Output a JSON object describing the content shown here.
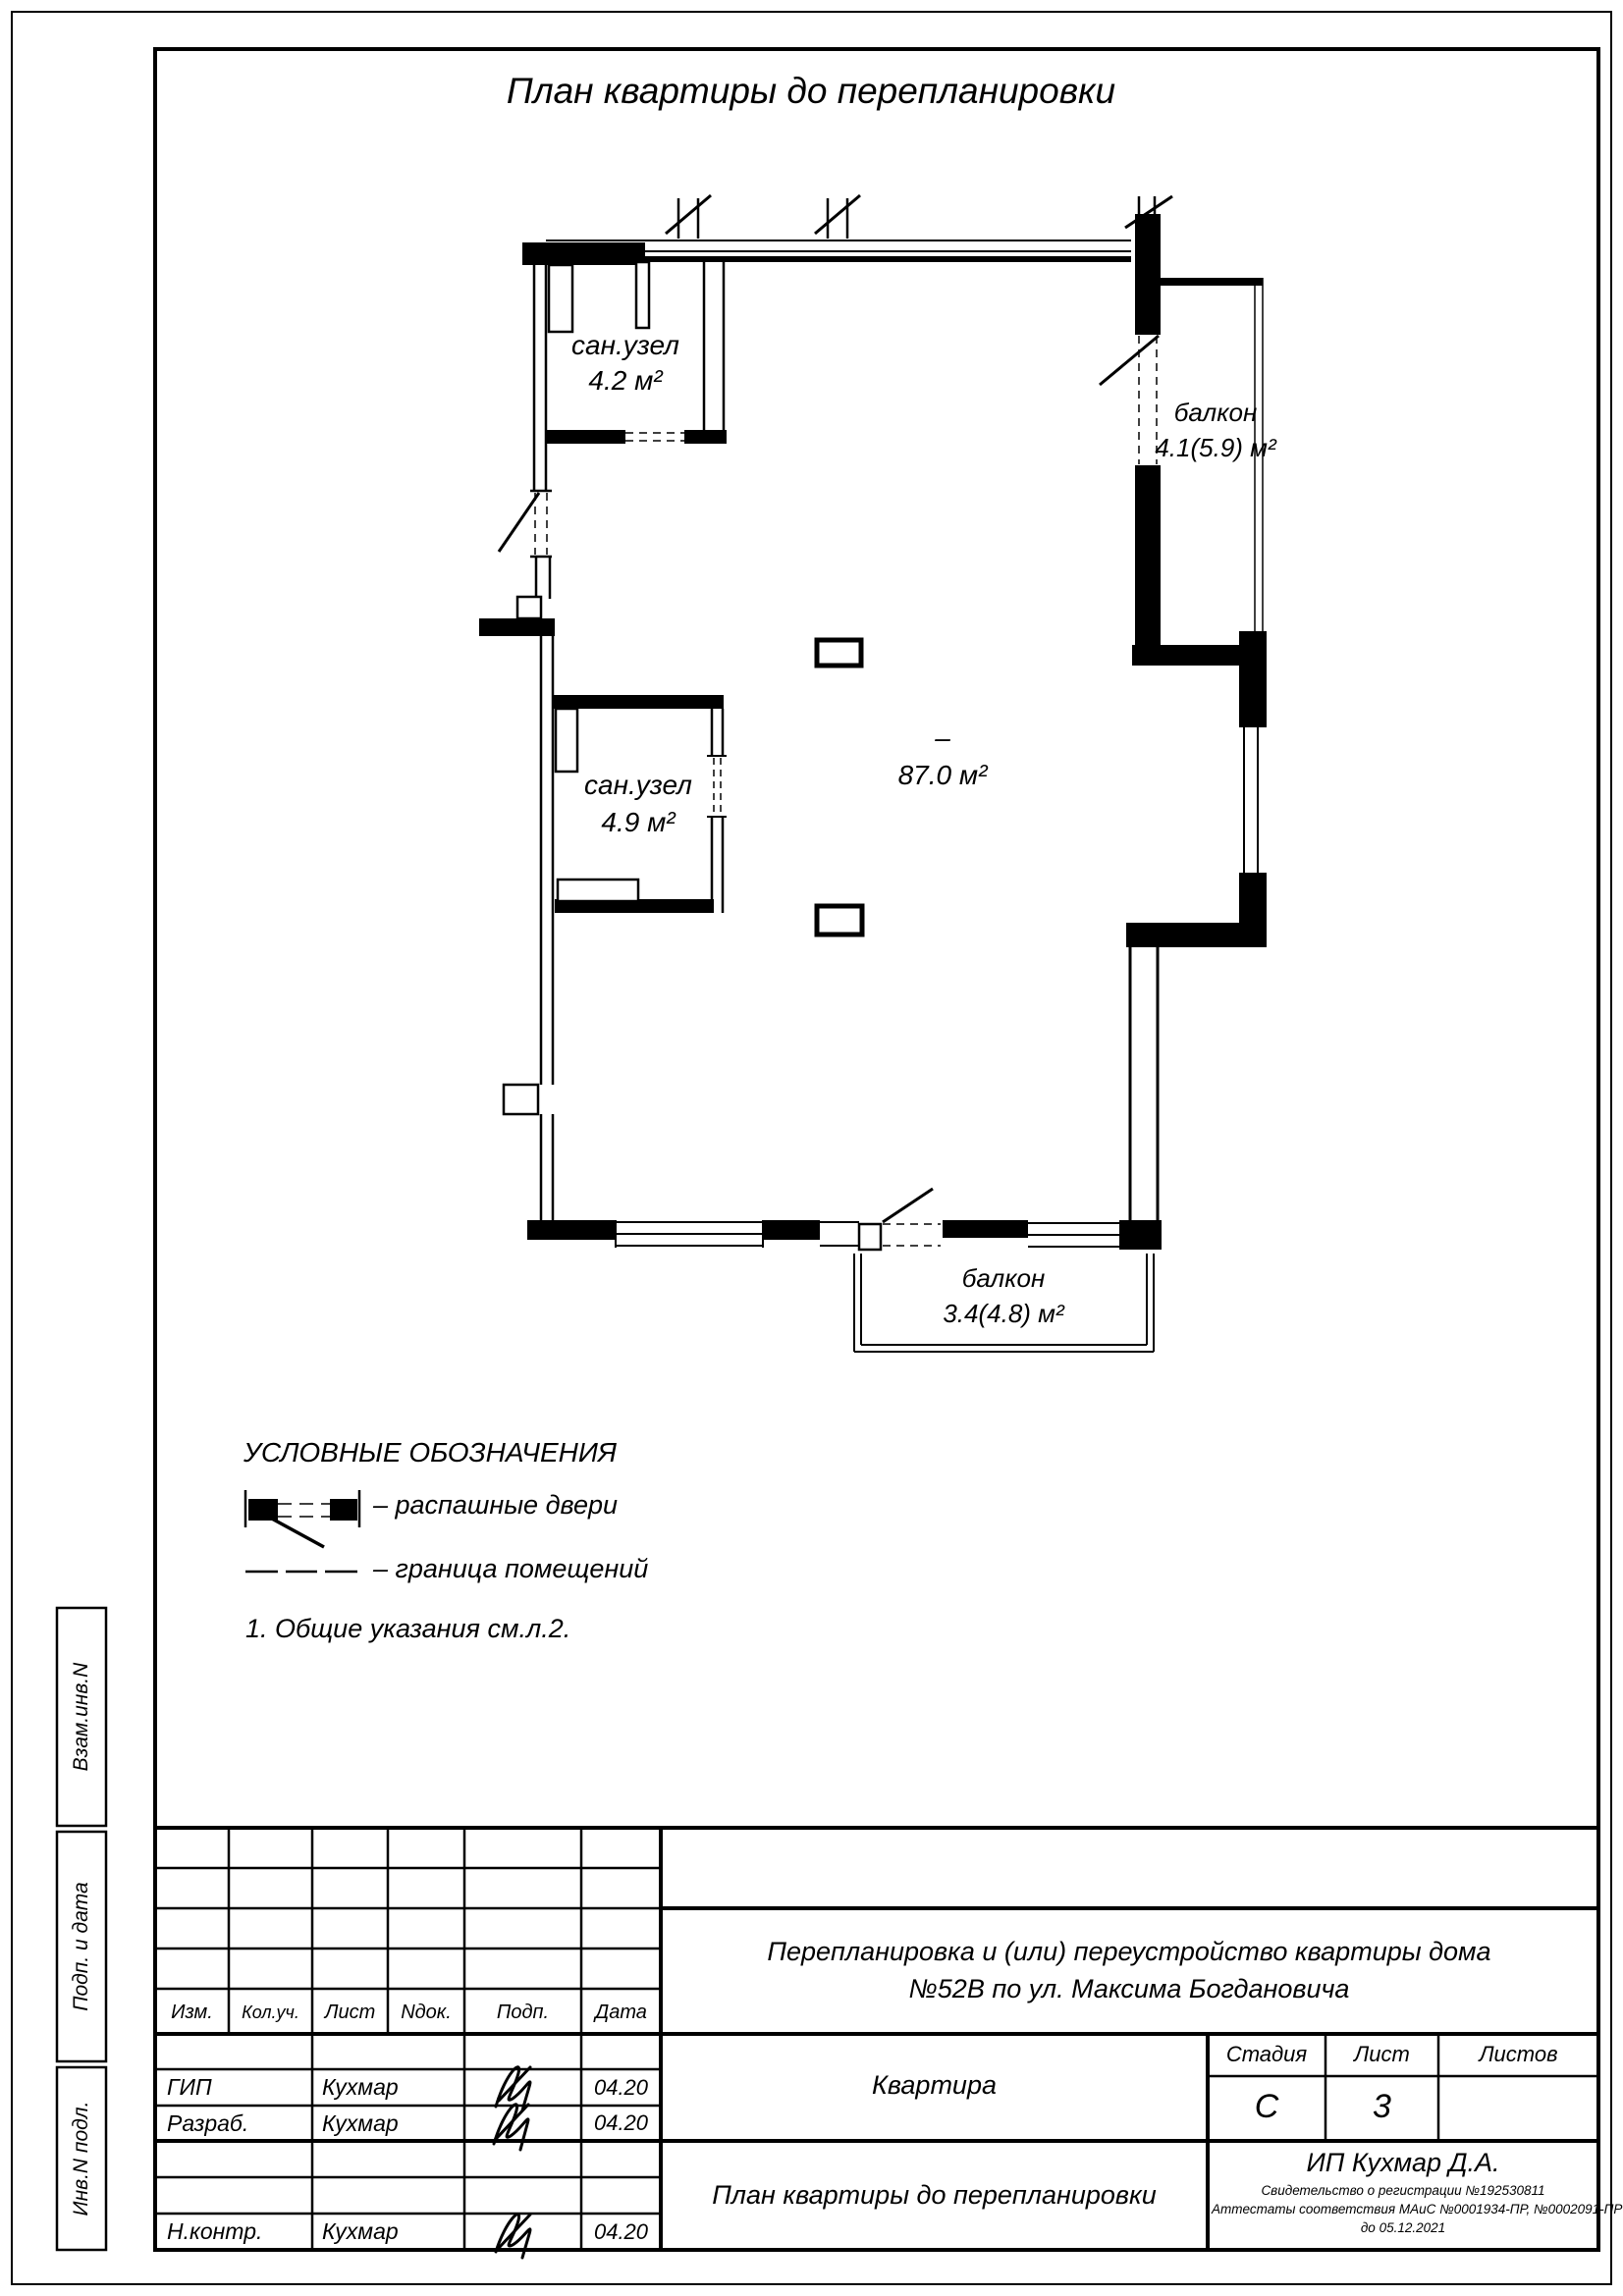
{
  "page": {
    "title": "План квартиры до перепланировки"
  },
  "plan": {
    "rooms": {
      "san42": {
        "name": "сан.узел",
        "area": "4.2 м²"
      },
      "san49": {
        "name": "сан.узел",
        "area": "4.9 м²"
      },
      "main": {
        "dash": "–",
        "area": "87.0 м²"
      },
      "balcony_right": {
        "name": "балкон",
        "area": "4.1(5.9) м²"
      },
      "balcony_bottom": {
        "name": "балкон",
        "area": "3.4(4.8) м²"
      }
    }
  },
  "legend": {
    "heading": "УСЛОВНЫЕ ОБОЗНАЧЕНИЯ",
    "items": [
      {
        "symbol": "swing-door-symbol",
        "label": "– распашные двери"
      },
      {
        "symbol": "room-boundary-symbol",
        "label": "– граница помещений"
      }
    ],
    "note": "1. Общие указания см.л.2."
  },
  "sidebar": {
    "cells": [
      "Взам.инв.N",
      "Подп. и дата",
      "Инв.N подл."
    ]
  },
  "titleblock": {
    "columns": [
      "Изм.",
      "Кол.уч.",
      "Лист",
      "Nдок.",
      "Подп.",
      "Дата"
    ],
    "rows": [
      {
        "role": "ГИП",
        "name": "Кухмар",
        "date": "04.20"
      },
      {
        "role": "Разраб.",
        "name": "Кухмар",
        "date": "04.20"
      },
      {
        "role": "Н.контр.",
        "name": "Кухмар",
        "date": "04.20"
      }
    ],
    "project": "Перепланировка и (или) переустройство квартиры дома №52В по ул. Максима Богдановича",
    "object": "Квартира",
    "sheet_title": "План квартиры до перепланировки",
    "stage_label": "Стадия",
    "sheet_label": "Лист",
    "sheets_label": "Листов",
    "stage": "С",
    "sheet": "3",
    "sheets": "",
    "firm": "ИП Кухмар Д.А.",
    "cert1": "Свидетельство о регистрации №192530811",
    "cert2": "Аттестаты соответствия МАиС №0001934-ПР, №0002091-ПР",
    "cert3": "до 05.12.2021",
    "ink": "#000000"
  }
}
